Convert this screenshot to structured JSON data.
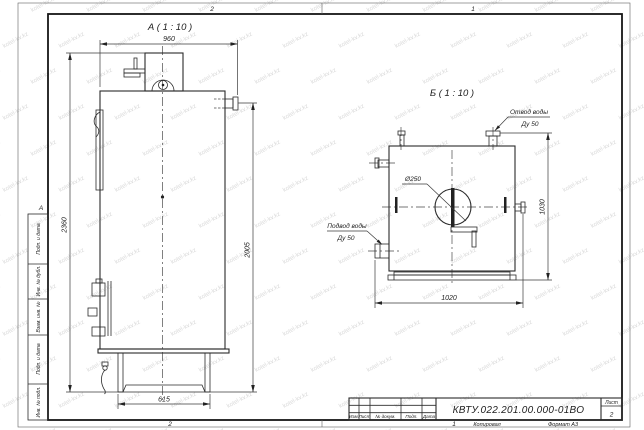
{
  "watermark": {
    "text": "kotel-kv.kz"
  },
  "sheet": {
    "zones": {
      "top_left": "2",
      "top_right": "1",
      "bottom_left": "2",
      "bottom_right": "1",
      "side": "А"
    },
    "stamp_columns": [
      "Подп. и дата",
      "Инв. № дубл.",
      "Взам. инв. №",
      "Подп. и дата",
      "Инв. № подл."
    ]
  },
  "view_a": {
    "title": "А ( 1 : 10 )",
    "dim_width": "960",
    "dim_height_total": "2360",
    "dim_height_right": "2005",
    "dim_base": "615"
  },
  "view_b": {
    "title": "Б ( 1 : 10 )",
    "dim_width": "1020",
    "dim_height": "1030",
    "dim_hole": "Ø250",
    "label_outlet": "Отвод воды",
    "label_outlet_dn": "Ду 50",
    "label_inlet": "Подвод воды",
    "label_inlet_dn": "Ду 50"
  },
  "title_block": {
    "doc_number": "КВТУ.022.201.00.000-01ВО",
    "sheet_label": "Лист",
    "sheet_number": "2",
    "columns": [
      "Изм.",
      "Лист",
      "№ докум.",
      "Подп.",
      "Дата"
    ],
    "copied": "Копировал",
    "format": "Формат А3"
  }
}
